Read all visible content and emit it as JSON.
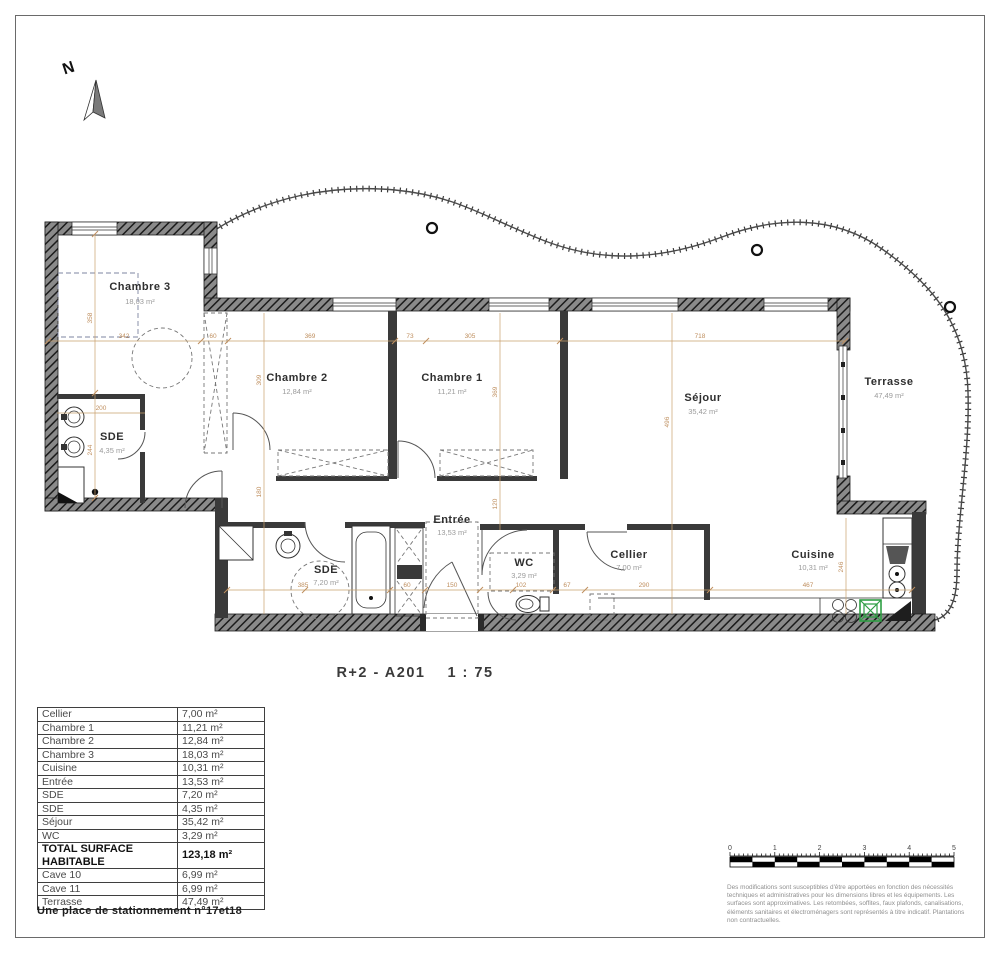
{
  "title": {
    "drawing": "R+2 - A201",
    "scale": "1 : 75"
  },
  "north": {
    "label": "N"
  },
  "colors": {
    "dimension": "#bf8f5f",
    "wall": "#3a3a3a",
    "fixture_green": "#2f9e44"
  },
  "plan": {
    "rooms": [
      {
        "name": "Chambre 3",
        "area": "18,03 m²"
      },
      {
        "name": "SDE",
        "area": "4,35 m²"
      },
      {
        "name": "Chambre 2",
        "area": "12,84 m²"
      },
      {
        "name": "Chambre 1",
        "area": "11,21 m²"
      },
      {
        "name": "Séjour",
        "area": "35,42 m²"
      },
      {
        "name": "Terrasse",
        "area": "47,49 m²"
      },
      {
        "name": "SDE",
        "area": "7,20 m²"
      },
      {
        "name": "Entrée",
        "area": "13,53 m²"
      },
      {
        "name": "WC",
        "area": "3,29 m²"
      },
      {
        "name": "Cellier",
        "area": "7,00 m²"
      },
      {
        "name": "Cuisine",
        "area": "10,31 m²"
      }
    ],
    "dims": [
      "342",
      "60",
      "369",
      "73",
      "305",
      "718",
      "385",
      "60",
      "150",
      "102",
      "67",
      "290",
      "467",
      "358",
      "244",
      "200",
      "309",
      "180",
      "369",
      "496",
      "120",
      "246"
    ]
  },
  "table": {
    "rows": [
      {
        "label": "Cellier",
        "value": "7,00 m²"
      },
      {
        "label": "Chambre 1",
        "value": "11,21 m²"
      },
      {
        "label": "Chambre 2",
        "value": "12,84 m²"
      },
      {
        "label": "Chambre 3",
        "value": "18,03 m²"
      },
      {
        "label": "Cuisine",
        "value": "10,31 m²"
      },
      {
        "label": "Entrée",
        "value": "13,53 m²"
      },
      {
        "label": "SDE",
        "value": "7,20 m²"
      },
      {
        "label": "SDE",
        "value": "4,35 m²"
      },
      {
        "label": "Séjour",
        "value": "35,42 m²"
      },
      {
        "label": "WC",
        "value": "3,29 m²"
      }
    ],
    "total": {
      "label": "TOTAL SURFACE HABITABLE",
      "value": "123,18 m²"
    },
    "annex": [
      {
        "label": "Cave 10",
        "value": "6,99 m²"
      },
      {
        "label": "Cave 11",
        "value": "6,99 m²"
      },
      {
        "label": "Terrasse",
        "value": "47,49 m²"
      }
    ],
    "note": "Une place de stationnement n°17et18"
  },
  "scalebar": {
    "labels": [
      "0",
      "1",
      "2",
      "3",
      "4",
      "5"
    ]
  },
  "disclaimer": "Des modifications sont susceptibles d'être apportées en fonction des nécessités techniques et administratives pour les dimensions libres et les équipements. Les surfaces sont approximatives. Les retombées, soffites, faux plafonds, canalisations, éléments sanitaires et électroménagers sont représentés à titre indicatif. Plantations non contractuelles."
}
